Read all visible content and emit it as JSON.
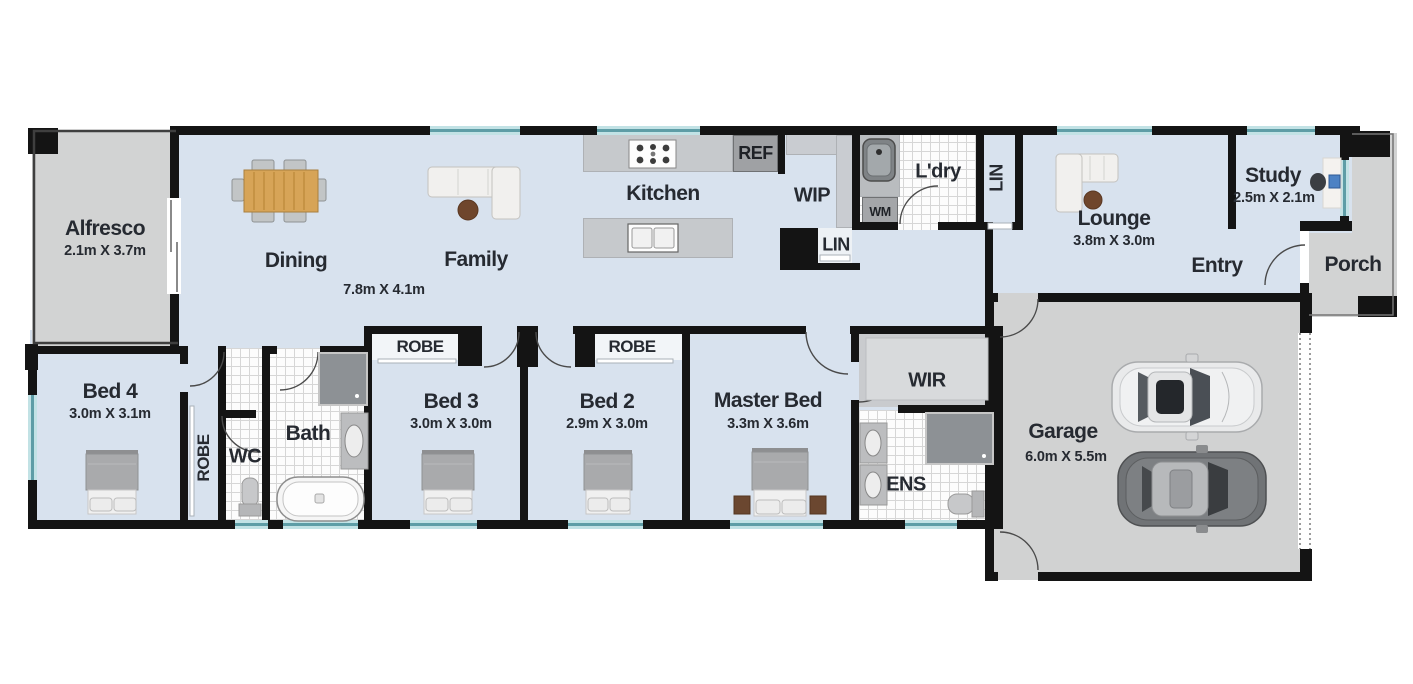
{
  "rooms": {
    "alfresco": {
      "label": "Alfresco",
      "dims": "2.1m X 3.7m"
    },
    "dining": {
      "label": "Dining"
    },
    "family": {
      "label": "Family",
      "dims": "7.8m X 4.1m"
    },
    "kitchen": {
      "label": "Kitchen"
    },
    "ref": {
      "label": "REF"
    },
    "wip": {
      "label": "WIP"
    },
    "lin_pantry": {
      "label": "LIN"
    },
    "laundry": {
      "label": "L'dry"
    },
    "wm": {
      "label": "WM"
    },
    "lin_hall": {
      "label": "LIN"
    },
    "lounge": {
      "label": "Lounge",
      "dims": "3.8m X 3.0m"
    },
    "study": {
      "label": "Study",
      "dims": "2.5m X 2.1m"
    },
    "entry": {
      "label": "Entry"
    },
    "porch": {
      "label": "Porch"
    },
    "bed4": {
      "label": "Bed 4",
      "dims": "3.0m X 3.1m"
    },
    "robe_hall": {
      "label": "ROBE"
    },
    "wc": {
      "label": "WC"
    },
    "bath": {
      "label": "Bath"
    },
    "robe_bed3": {
      "label": "ROBE"
    },
    "bed3": {
      "label": "Bed 3",
      "dims": "3.0m X 3.0m"
    },
    "robe_bed2": {
      "label": "ROBE"
    },
    "bed2": {
      "label": "Bed 2",
      "dims": "2.9m X 3.0m"
    },
    "master": {
      "label": "Master Bed",
      "dims": "3.3m X 3.6m"
    },
    "wir": {
      "label": "WIR"
    },
    "ens": {
      "label": "ENS"
    },
    "garage": {
      "label": "Garage",
      "dims": "6.0m X 5.5m"
    }
  },
  "colors": {
    "wall": "#141414",
    "interior_floor": "#d8e2ee",
    "outdoor_floor": "#d2d3d3",
    "window": "#5e9da6",
    "bench": "#c6c9cc",
    "appliance": "#9fa1a4",
    "text": "#262a31"
  }
}
